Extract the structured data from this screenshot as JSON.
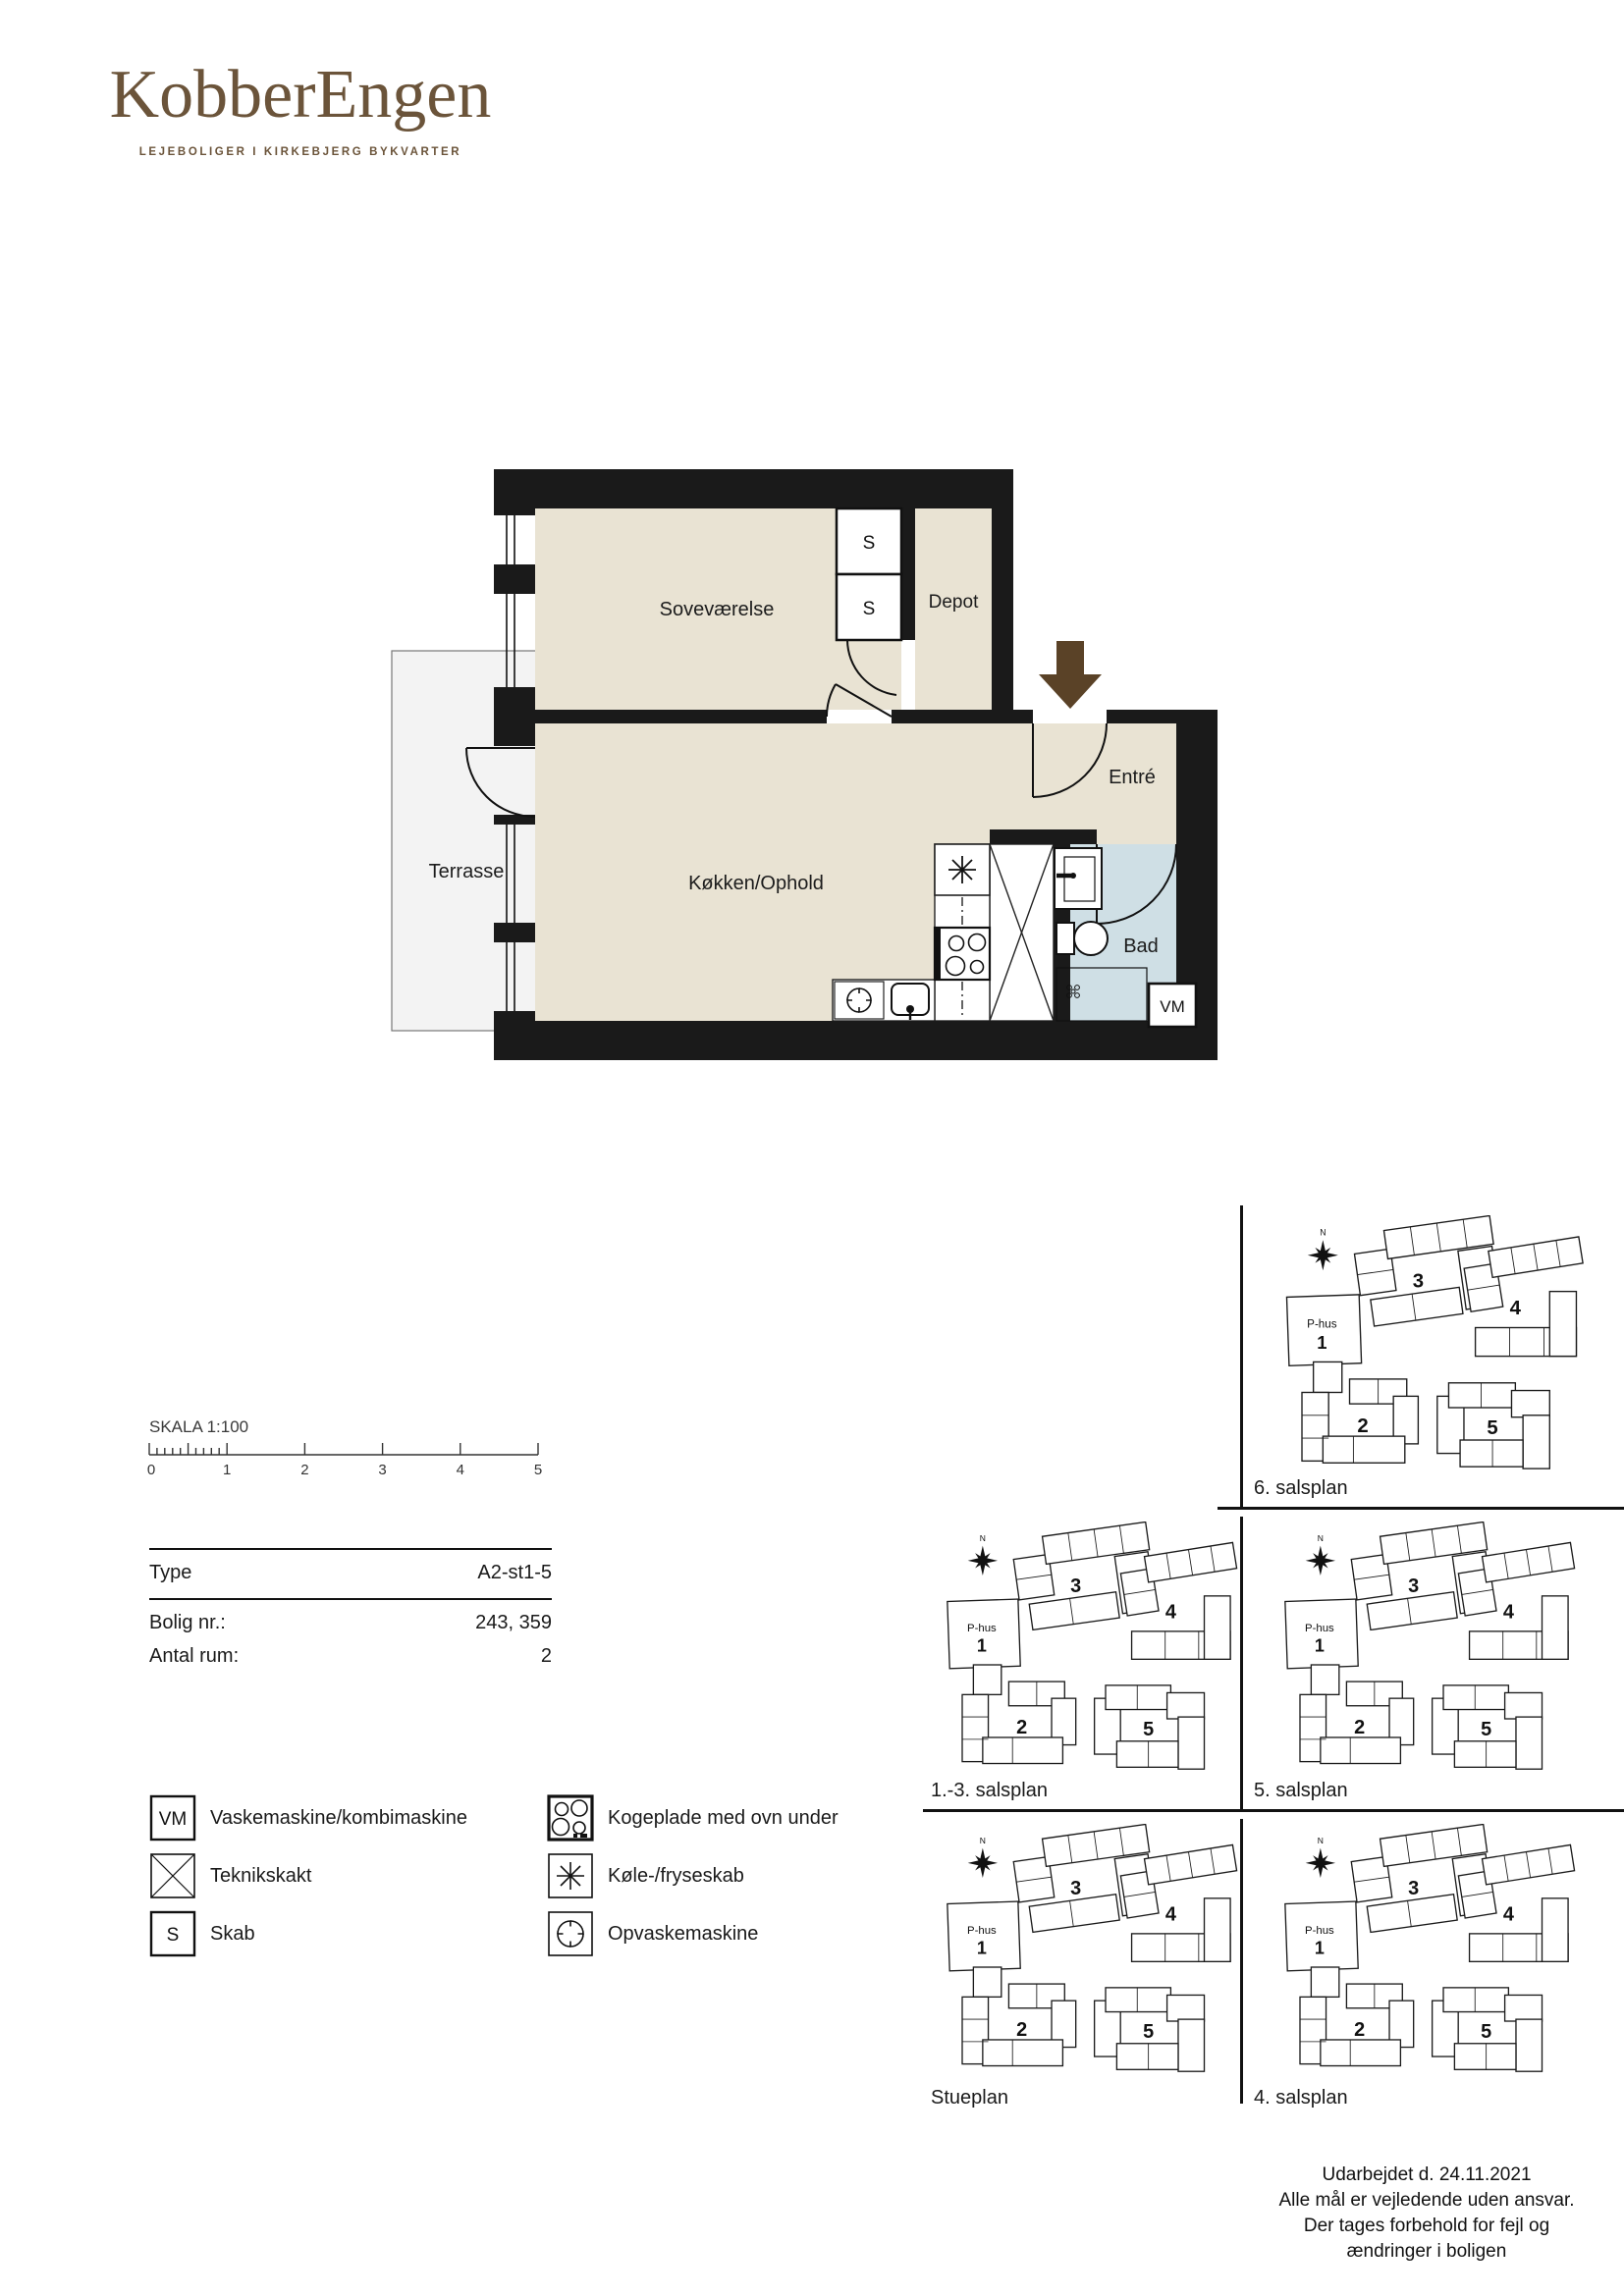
{
  "brand": {
    "name": "KobberEngen",
    "tagline": "LEJEBOLIGER I KIRKEBJERG BYKVARTER",
    "color": "#6b543a"
  },
  "floorplan": {
    "rooms": {
      "bedroom": "Soveværelse",
      "depot": "Depot",
      "entry": "Entré",
      "kitchen": "Køkken/Ophold",
      "bath": "Bad",
      "terrace": "Terrasse"
    },
    "markers": {
      "washer": "VM",
      "closet": "S"
    },
    "colors": {
      "floor": "#e9e3d3",
      "bath_floor": "#cfdfe5",
      "terrace": "#f3f3f3",
      "wall": "#1a1a1a",
      "entry_arrow": "#5a4227"
    }
  },
  "scalebar": {
    "label": "SKALA 1:100",
    "ticks": [
      "0",
      "1",
      "2",
      "3",
      "4",
      "5"
    ]
  },
  "info": {
    "rows": [
      {
        "label": "Type",
        "value": "A2-st1-5"
      },
      {
        "label": "Bolig nr.:",
        "value": "243, 359"
      },
      {
        "label": "Antal rum:",
        "value": "2"
      }
    ]
  },
  "legend": {
    "left": [
      {
        "symbol": "VM",
        "label": "Vaskemaskine/kombimaskine"
      },
      {
        "symbol": "",
        "label": "Teknikskakt"
      },
      {
        "symbol": "S",
        "label": "Skab"
      }
    ],
    "right": [
      {
        "label": "Kogeplade med ovn under"
      },
      {
        "label": "Køle-/fryseskab"
      },
      {
        "label": "Opvaskemaskine"
      }
    ]
  },
  "siteplans": {
    "maps": [
      {
        "label": "6. salsplan"
      },
      {
        "label": "1.-3. salsplan"
      },
      {
        "label": "5. salsplan"
      },
      {
        "label": "Stueplan"
      },
      {
        "label": "4. salsplan"
      }
    ],
    "buildings": {
      "b3": "3",
      "b4": "4",
      "b2": "2",
      "b5": "5",
      "phus_name": "P-hus",
      "phus_num": "1",
      "north": "N"
    }
  },
  "footer": {
    "lines": [
      "Udarbejdet d. 24.11.2021",
      "Alle mål er vejledende uden ansvar.",
      "Der tages forbehold for fejl og",
      "ændringer i boligen"
    ]
  }
}
